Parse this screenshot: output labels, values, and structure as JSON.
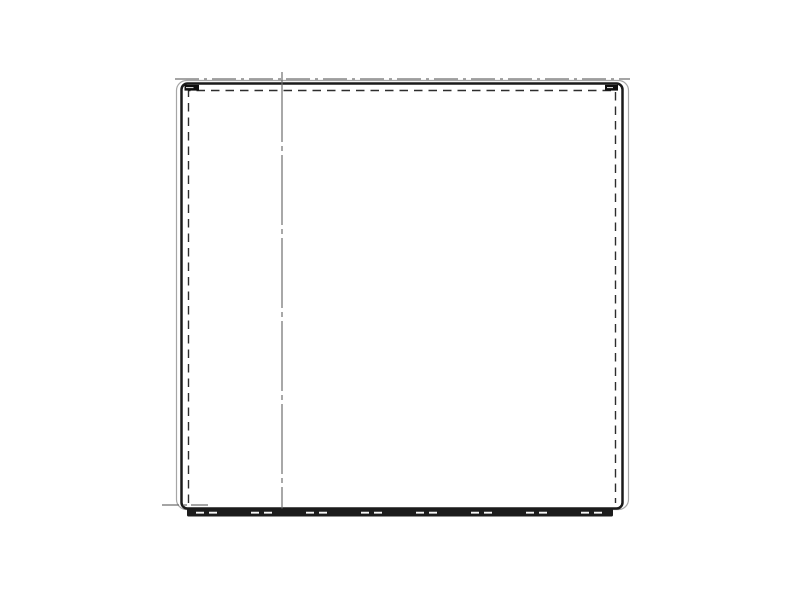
{
  "drawing": {
    "name": "appliance-door-panel-front-view-line-drawing",
    "background": "#ffffff",
    "colors": {
      "outline_dark": "#1a1a1a",
      "outline_light": "#a6a6a6",
      "centerline_gray": "#6f6f6f",
      "hidden_dash_dark": "#2d2d2d",
      "base_band_fill": "#1c1c1c",
      "base_band_dash": "#f7f7f7",
      "corner_clip_fill": "#0e0e0e",
      "corner_clip_slit": "#e8e8e8"
    },
    "elements": {
      "outer_outline": "outer-rounded-rectangle-thin",
      "inner_outline": "inner-rounded-rectangle-thick",
      "hidden_edge": "inner-dashed-hidden-edge",
      "top_centerline": "horizontal-dash-dot-centerline-top",
      "vertical_centerline": "vertical-dash-dot-centerline",
      "bottom_left_centerline": "short-dash-dot-centerline-bottom-left",
      "base_band": "bottom-base-bar-with-dashed-seam",
      "corner_clips": "small-corner-hinge-clips-top-left-and-top-right"
    }
  }
}
